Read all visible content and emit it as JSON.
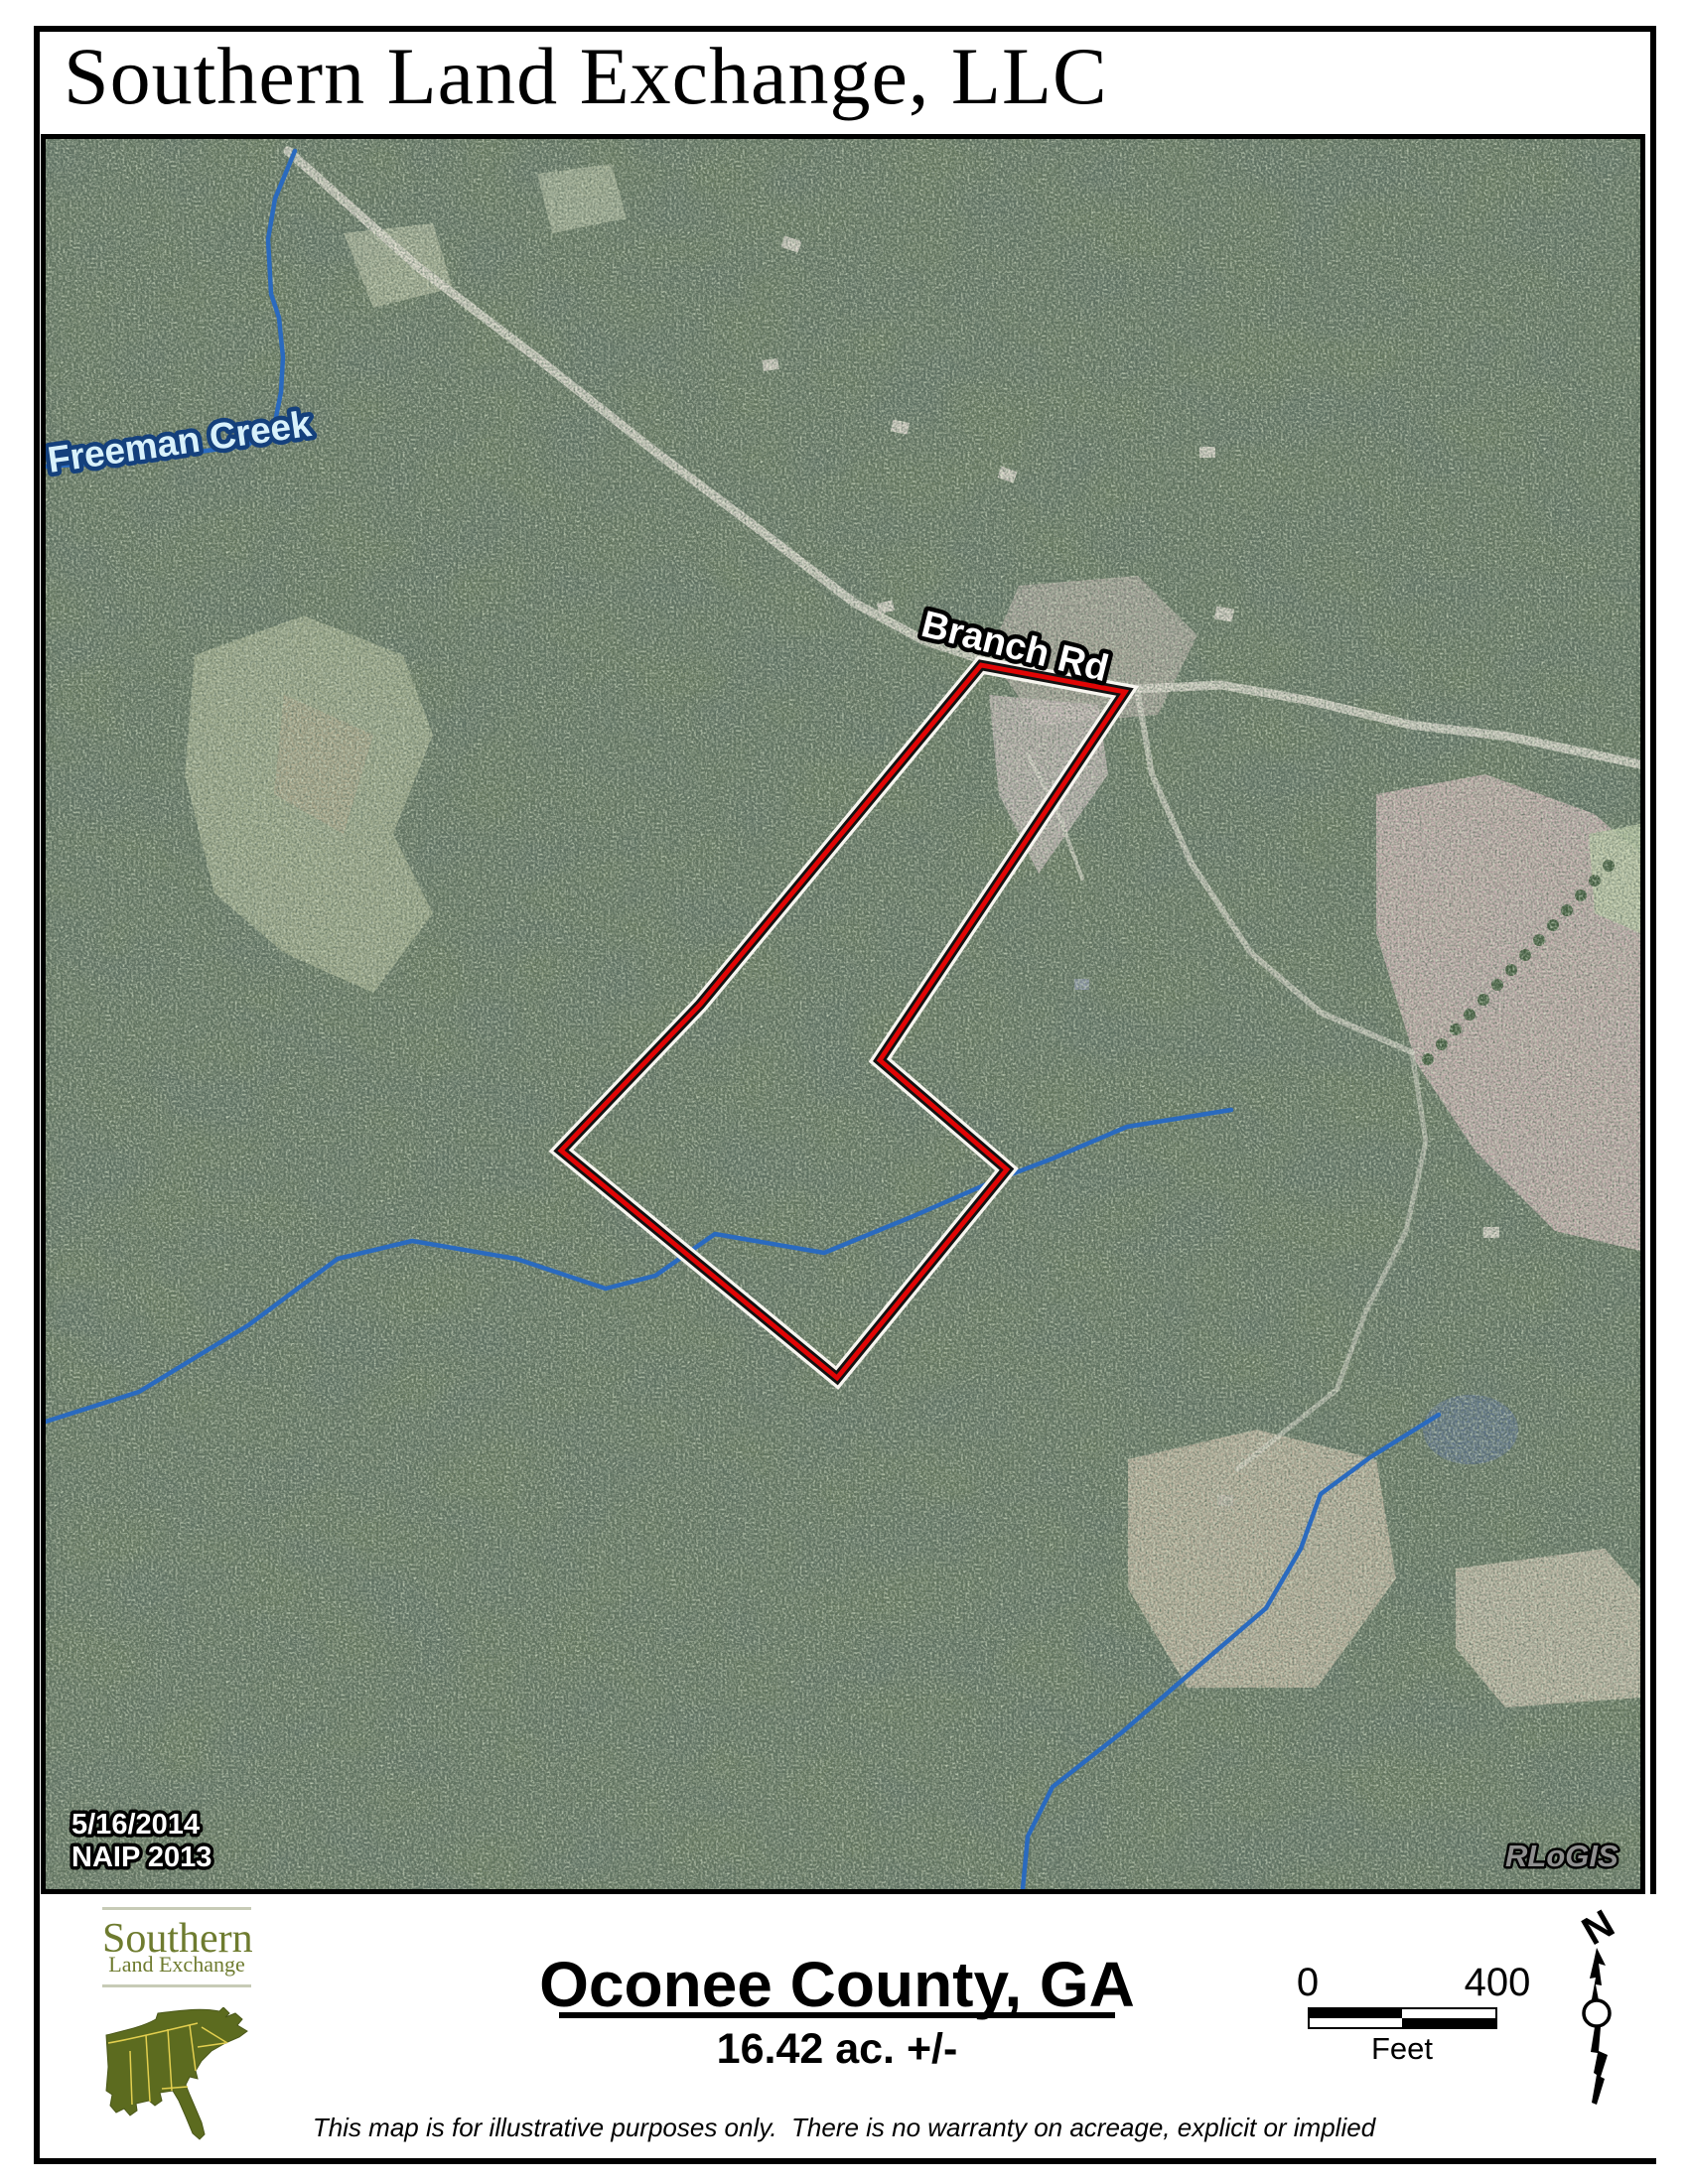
{
  "title": "Southern Land Exchange, LLC",
  "map": {
    "labels": {
      "creek": "Freeman Creek",
      "road": "Branch Rd",
      "date_line1": "5/16/2014",
      "date_line2": "NAIP 2013",
      "credit": "RLoGIS"
    },
    "colors": {
      "parcel_outline_red": "#e00505",
      "parcel_casing_black": "#121212",
      "parcel_halo_white": "#f8f6f0",
      "creek_blue": "#2a6abf",
      "creek_label_fill": "#d8f1fb",
      "creek_label_halo": "#14407c",
      "forest_base": "#66785f"
    }
  },
  "footer": {
    "logo": {
      "line1": "Southern",
      "line2": "Land Exchange",
      "green": "#5c6b1f",
      "state_line": "#e3cf4f"
    },
    "county": "Oconee County, GA",
    "acreage": "16.42 ac. +/-",
    "scalebar": {
      "start": "0",
      "end": "400",
      "unit": "Feet"
    },
    "north": "N",
    "disclaimer": "This map is for illustrative purposes only.  There is no warranty on acreage, explicit or implied"
  }
}
